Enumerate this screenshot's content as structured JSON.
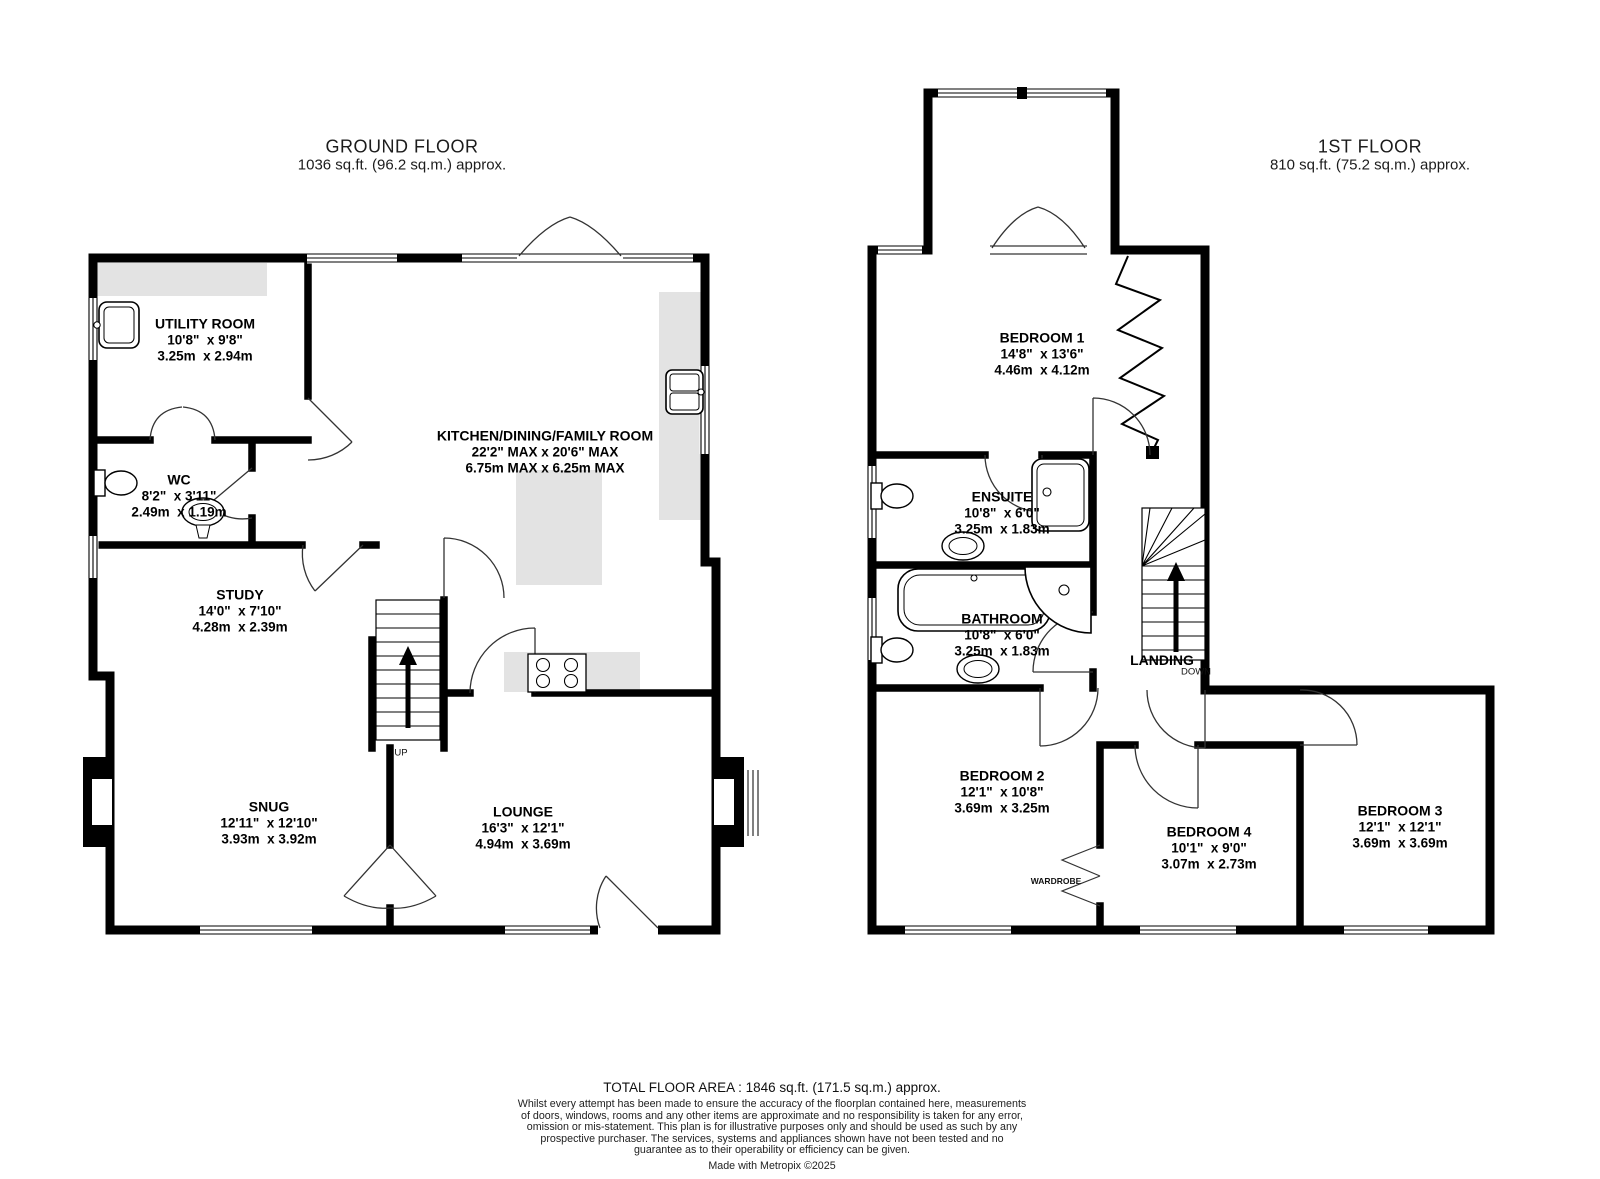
{
  "ground_floor": {
    "title": "GROUND FLOOR",
    "area": "1036 sq.ft. (96.2 sq.m.) approx.",
    "rooms": [
      {
        "name": "UTILITY ROOM",
        "imperial": "10'8\"  x 9'8\"",
        "metric": "3.25m  x 2.94m"
      },
      {
        "name": "WC",
        "imperial": "8'2\"  x 3'11\"",
        "metric": "2.49m  x 1.19m"
      },
      {
        "name": "KITCHEN/DINING/FAMILY ROOM",
        "imperial": "22'2\" MAX x 20'6\" MAX",
        "metric": "6.75m MAX x 6.25m MAX"
      },
      {
        "name": "STUDY",
        "imperial": "14'0\"  x 7'10\"",
        "metric": "4.28m  x 2.39m"
      },
      {
        "name": "SNUG",
        "imperial": "12'11\"  x 12'10\"",
        "metric": "3.93m  x 3.92m"
      },
      {
        "name": "LOUNGE",
        "imperial": "16'3\"  x 12'1\"",
        "metric": "4.94m  x 3.69m"
      }
    ],
    "stairs_label": "UP"
  },
  "first_floor": {
    "title": "1ST FLOOR",
    "area": "810 sq.ft. (75.2 sq.m.) approx.",
    "rooms": [
      {
        "name": "BEDROOM 1",
        "imperial": "14'8\"  x 13'6\"",
        "metric": "4.46m  x 4.12m"
      },
      {
        "name": "ENSUITE",
        "imperial": "10'8\"  x 6'0\"",
        "metric": "3.25m  x 1.83m"
      },
      {
        "name": "BATHROOM",
        "imperial": "10'8\"  x 6'0\"",
        "metric": "3.25m  x 1.83m"
      },
      {
        "name": "BEDROOM 2",
        "imperial": "12'1\"  x 10'8\"",
        "metric": "3.69m  x 3.25m"
      },
      {
        "name": "BEDROOM 4",
        "imperial": "10'1\"  x 9'0\"",
        "metric": "3.07m  x 2.73m"
      },
      {
        "name": "BEDROOM 3",
        "imperial": "12'1\"  x 12'1\"",
        "metric": "3.69m  x 3.69m"
      }
    ],
    "landing_label": "LANDING",
    "stairs_label": "DOWN",
    "wardrobe_label": "WARDROBE"
  },
  "footer": {
    "total_area": "TOTAL FLOOR AREA : 1846 sq.ft. (171.5 sq.m.) approx.",
    "disclaimer": "Whilst every attempt has been made to ensure the accuracy of the floorplan contained here, measurements of doors, windows, rooms and any other items are approximate and no responsibility is taken for any error, omission or mis-statement. This plan is for illustrative purposes only and should be used as such by any prospective purchaser. The services, systems and appliances shown have not been tested and no guarantee as to their operability or efficiency can be given.",
    "credit": "Made with Metropix ©2025"
  },
  "colors": {
    "wall": "#000000",
    "counter": "#e3e3e3",
    "door_line": "#333333"
  }
}
